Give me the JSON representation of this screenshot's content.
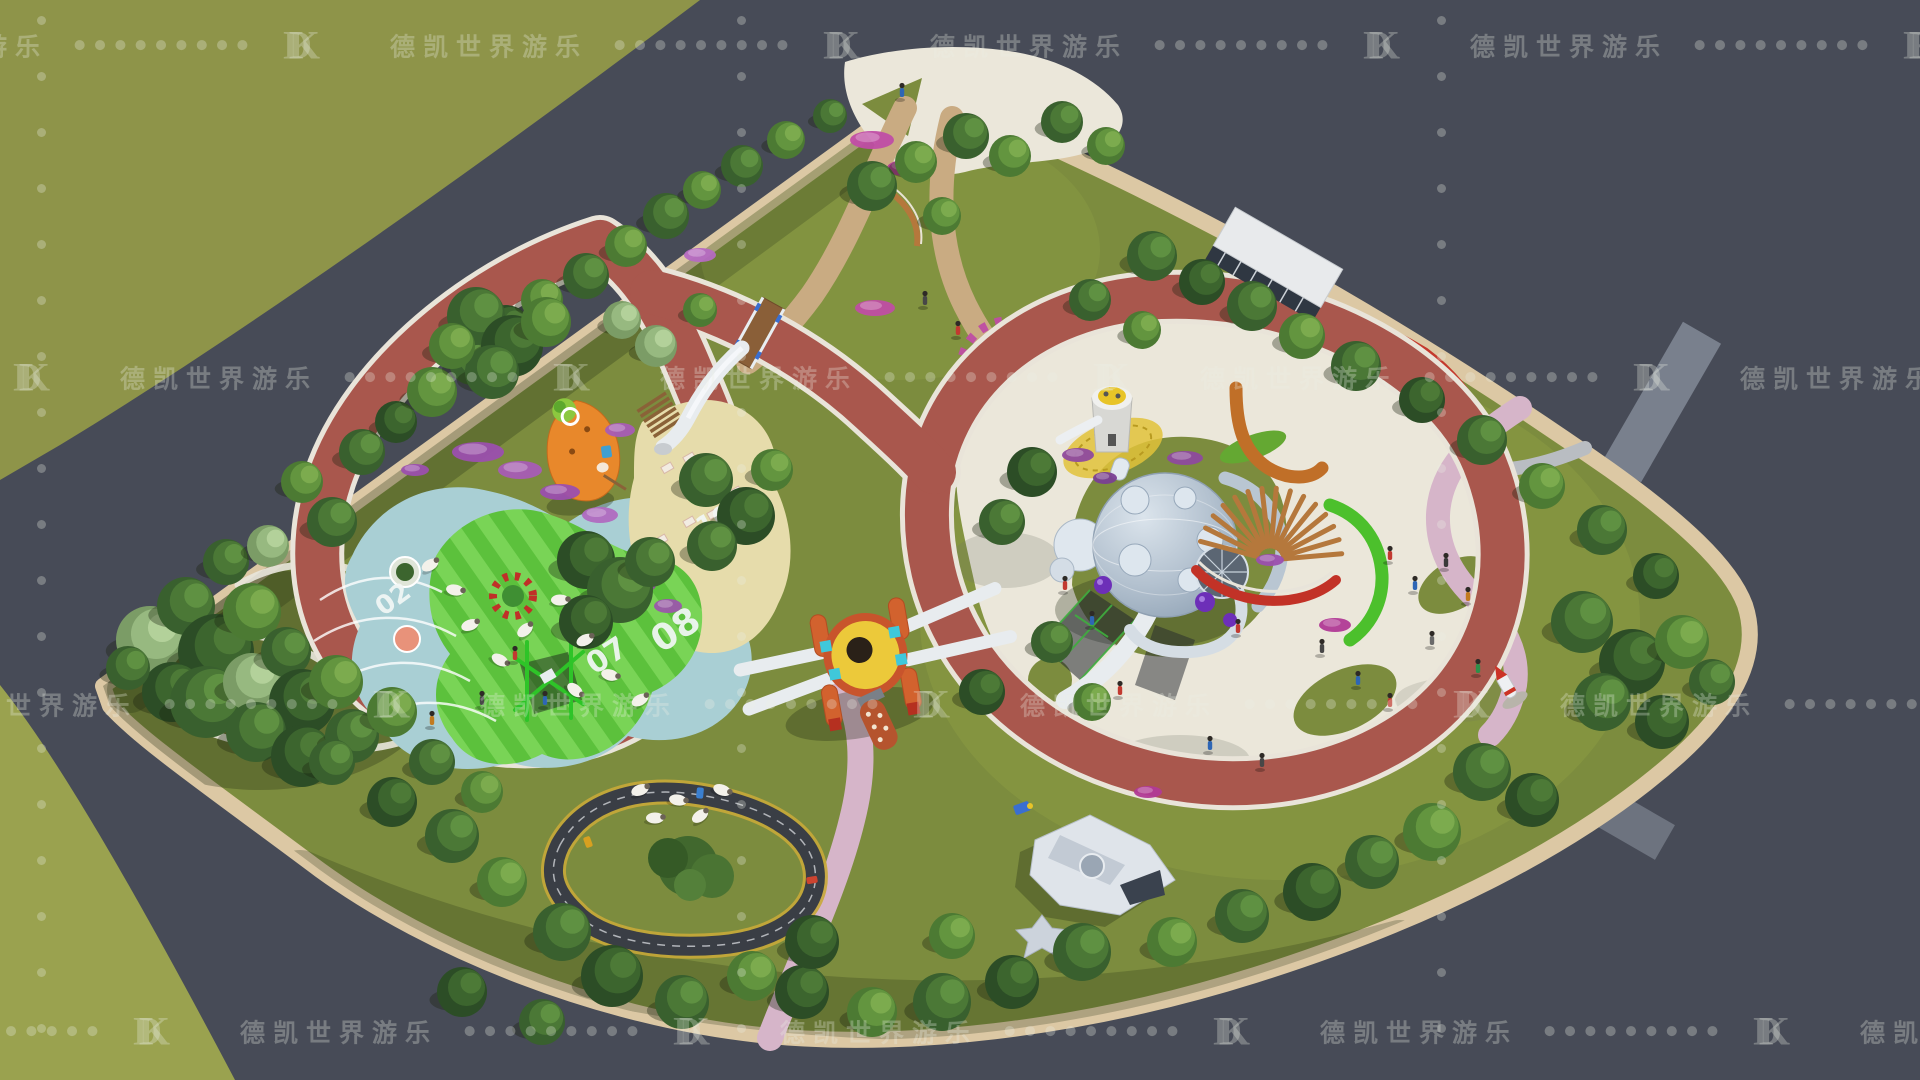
{
  "watermark": {
    "logo": "DK",
    "brand": "德凯世界游乐",
    "dot_char": "●",
    "dots_per_group": 9,
    "rows": [
      {
        "y": 45,
        "dx": -150
      },
      {
        "y": 377,
        "dx": -420
      },
      {
        "y": 704,
        "dx": -60
      },
      {
        "y": 1031,
        "dx": -300
      }
    ],
    "tiles_per_row": 6,
    "columns_x": [
      41,
      741,
      1441
    ],
    "column_dots": 20,
    "color": "rgba(236,240,228,0.30)"
  },
  "labels": {
    "n02": "02",
    "n07": "07",
    "n08": "08",
    "n10": "10"
  },
  "palette": {
    "road": "#474b57",
    "grassTL": "#8e9449",
    "grassBL": "#9aa24f",
    "lawn": "#7c8c3e",
    "sidewalk": "#dcc8a4",
    "trackRed": "#a9574d",
    "trackEdge": "#e9e4d9",
    "pathPink": "#d6b5c9",
    "pathTan": "#c9ab82",
    "plaza": "#ebe7da",
    "teal": "#a9cfd4",
    "stripeA": "#5cc13c",
    "stripeB": "#79d456",
    "sand": "#e6dcab",
    "hedge": "#4cc02c",
    "wood": "#b5783c",
    "accentRed": "#c23227",
    "sphereBody": "#b9c6d2",
    "slideWhite": "#e8ecef",
    "rocketYellow": "#ecc93a",
    "rocketOrange": "#d2622e",
    "connectorCyan": "#3fc8da",
    "kartAsphalt": "#3a3e45",
    "kartYellow": "#c8a838",
    "pondGreen": "#3fa436",
    "carrotOrange": "#e8882b",
    "numberWhite": "#f2f7f6",
    "watermark": "rgba(236,240,228,0.30)"
  },
  "scene": {
    "tree_palette": [
      [
        "#2c4d26",
        "#3c652e",
        "#4d7a37"
      ],
      [
        "#39602e",
        "#4b7836",
        "#5f9142"
      ],
      [
        "#4c7a33",
        "#63953f",
        "#7cab4e"
      ],
      [
        "#7b9c66",
        "#97b980",
        "#b3d19a"
      ]
    ],
    "trees": [
      [
        150,
        640,
        34,
        3
      ],
      [
        186,
        606,
        29,
        1
      ],
      [
        216,
        652,
        38,
        0
      ],
      [
        252,
        612,
        29,
        2
      ],
      [
        172,
        692,
        30,
        0
      ],
      [
        206,
        702,
        36,
        1
      ],
      [
        252,
        682,
        29,
        3
      ],
      [
        286,
        652,
        25,
        1
      ],
      [
        302,
        702,
        33,
        0
      ],
      [
        336,
        682,
        27,
        2
      ],
      [
        256,
        732,
        30,
        1
      ],
      [
        302,
        756,
        31,
        0
      ],
      [
        352,
        736,
        27,
        1
      ],
      [
        392,
        712,
        25,
        2
      ],
      [
        226,
        562,
        23,
        1
      ],
      [
        268,
        546,
        21,
        3
      ],
      [
        128,
        668,
        22,
        1
      ],
      [
        332,
        522,
        25,
        1
      ],
      [
        302,
        482,
        21,
        2
      ],
      [
        362,
        452,
        23,
        1
      ],
      [
        396,
        422,
        21,
        0
      ],
      [
        432,
        392,
        25,
        2
      ],
      [
        472,
        362,
        23,
        1
      ],
      [
        506,
        330,
        25,
        0
      ],
      [
        542,
        300,
        21,
        2
      ],
      [
        586,
        276,
        23,
        1
      ],
      [
        626,
        246,
        21,
        2
      ],
      [
        666,
        216,
        23,
        1
      ],
      [
        702,
        190,
        19,
        2
      ],
      [
        742,
        166,
        21,
        1
      ],
      [
        786,
        140,
        19,
        2
      ],
      [
        830,
        116,
        17,
        1
      ],
      [
        476,
        316,
        29,
        1
      ],
      [
        512,
        346,
        31,
        0
      ],
      [
        546,
        322,
        25,
        2
      ],
      [
        492,
        372,
        27,
        1
      ],
      [
        452,
        346,
        23,
        2
      ],
      [
        586,
        560,
        29,
        0
      ],
      [
        620,
        590,
        33,
        1
      ],
      [
        586,
        622,
        27,
        0
      ],
      [
        650,
        562,
        25,
        1
      ],
      [
        706,
        480,
        27,
        1
      ],
      [
        746,
        516,
        29,
        0
      ],
      [
        712,
        546,
        25,
        1
      ],
      [
        772,
        470,
        21,
        2
      ],
      [
        872,
        186,
        25,
        1
      ],
      [
        916,
        162,
        21,
        2
      ],
      [
        966,
        136,
        23,
        1
      ],
      [
        1010,
        156,
        21,
        2
      ],
      [
        942,
        216,
        19,
        2
      ],
      [
        1062,
        122,
        21,
        1
      ],
      [
        1106,
        146,
        19,
        2
      ],
      [
        1090,
        300,
        21,
        1
      ],
      [
        1142,
        330,
        19,
        2
      ],
      [
        656,
        346,
        21,
        3
      ],
      [
        622,
        320,
        19,
        3
      ],
      [
        700,
        310,
        17,
        2
      ],
      [
        1152,
        256,
        25,
        1
      ],
      [
        1202,
        282,
        23,
        0
      ],
      [
        1252,
        306,
        25,
        1
      ],
      [
        1302,
        336,
        23,
        2
      ],
      [
        1356,
        366,
        25,
        1
      ],
      [
        1422,
        400,
        23,
        0
      ],
      [
        1482,
        440,
        25,
        1
      ],
      [
        1542,
        486,
        23,
        2
      ],
      [
        1602,
        530,
        25,
        1
      ],
      [
        1656,
        576,
        23,
        0
      ],
      [
        1582,
        622,
        31,
        1
      ],
      [
        1632,
        662,
        33,
        0
      ],
      [
        1682,
        642,
        27,
        2
      ],
      [
        1602,
        702,
        29,
        1
      ],
      [
        1662,
        722,
        27,
        0
      ],
      [
        1712,
        682,
        23,
        1
      ],
      [
        1482,
        772,
        29,
        1
      ],
      [
        1532,
        800,
        27,
        0
      ],
      [
        1432,
        832,
        29,
        2
      ],
      [
        1372,
        862,
        27,
        1
      ],
      [
        1312,
        892,
        29,
        0
      ],
      [
        1242,
        916,
        27,
        1
      ],
      [
        1172,
        942,
        25,
        2
      ],
      [
        1082,
        952,
        29,
        1
      ],
      [
        1012,
        982,
        27,
        0
      ],
      [
        942,
        1002,
        29,
        1
      ],
      [
        872,
        1012,
        25,
        2
      ],
      [
        802,
        992,
        27,
        0
      ],
      [
        952,
        936,
        23,
        2
      ],
      [
        562,
        932,
        29,
        1
      ],
      [
        612,
        976,
        31,
        0
      ],
      [
        682,
        1002,
        27,
        1
      ],
      [
        752,
        976,
        25,
        2
      ],
      [
        812,
        942,
        27,
        0
      ],
      [
        502,
        882,
        25,
        2
      ],
      [
        452,
        836,
        27,
        1
      ],
      [
        392,
        802,
        25,
        0
      ],
      [
        332,
        762,
        23,
        1
      ],
      [
        542,
        1022,
        23,
        1
      ],
      [
        462,
        992,
        25,
        0
      ],
      [
        432,
        762,
        23,
        1
      ],
      [
        482,
        792,
        21,
        2
      ],
      [
        1032,
        472,
        25,
        0
      ],
      [
        1002,
        522,
        23,
        1
      ],
      [
        1052,
        642,
        21,
        1
      ],
      [
        982,
        692,
        23,
        0
      ],
      [
        1092,
        702,
        19,
        2
      ]
    ],
    "bushes": [
      [
        478,
        452,
        26,
        10,
        "#9b4fae"
      ],
      [
        520,
        470,
        22,
        9,
        "#a85cb5"
      ],
      [
        560,
        492,
        20,
        8,
        "#9b4fae"
      ],
      [
        600,
        515,
        18,
        8,
        "#b06ac0"
      ],
      [
        640,
        585,
        16,
        8,
        "#8e4a9e"
      ],
      [
        668,
        606,
        14,
        7,
        "#9b57ab"
      ],
      [
        872,
        140,
        22,
        9,
        "#c04da5"
      ],
      [
        905,
        168,
        18,
        8,
        "#b13a96"
      ],
      [
        875,
        308,
        20,
        8,
        "#bf4da3"
      ],
      [
        1078,
        455,
        16,
        7,
        "#8e4a9e"
      ],
      [
        1105,
        478,
        12,
        6,
        "#7a3f93"
      ],
      [
        1185,
        458,
        18,
        7,
        "#8e4a9e"
      ],
      [
        1270,
        560,
        14,
        6,
        "#9b4fae"
      ],
      [
        1335,
        625,
        16,
        7,
        "#b13a96"
      ],
      [
        415,
        470,
        14,
        6,
        "#9b4fae"
      ],
      [
        620,
        430,
        15,
        7,
        "#a85cb5"
      ],
      [
        1148,
        792,
        14,
        6,
        "#b13a96"
      ],
      [
        700,
        255,
        16,
        7,
        "#b56ac2"
      ]
    ],
    "sheep": [
      [
        430,
        565,
        -30
      ],
      [
        455,
        590,
        10
      ],
      [
        470,
        625,
        -20
      ],
      [
        500,
        660,
        30
      ],
      [
        525,
        630,
        -40
      ],
      [
        560,
        600,
        0
      ],
      [
        585,
        640,
        -25
      ],
      [
        610,
        675,
        15
      ],
      [
        640,
        700,
        -30
      ],
      [
        575,
        690,
        40
      ],
      [
        640,
        790,
        -20
      ],
      [
        678,
        800,
        10
      ],
      [
        700,
        816,
        -35
      ],
      [
        722,
        790,
        20
      ],
      [
        655,
        818,
        0
      ]
    ],
    "people": [
      [
        1390,
        555,
        "#c23a30"
      ],
      [
        1415,
        585,
        "#2e66b5"
      ],
      [
        1446,
        562,
        "#3a3a3a"
      ],
      [
        1468,
        596,
        "#c27b20"
      ],
      [
        1358,
        680,
        "#2e66b5"
      ],
      [
        1390,
        702,
        "#c23a30"
      ],
      [
        1322,
        648,
        "#474747"
      ],
      [
        1432,
        640,
        "#6a6a6a"
      ],
      [
        1478,
        668,
        "#2e8f4a"
      ],
      [
        1238,
        628,
        "#c23a30"
      ],
      [
        1210,
        745,
        "#2e66b5"
      ],
      [
        1262,
        762,
        "#474747"
      ],
      [
        1120,
        690,
        "#c23a30"
      ],
      [
        1065,
        585,
        "#c23a30"
      ],
      [
        1092,
        620,
        "#2e66b5"
      ],
      [
        515,
        655,
        "#c23a30"
      ],
      [
        545,
        700,
        "#2e66b5"
      ],
      [
        482,
        700,
        "#474747"
      ],
      [
        432,
        720,
        "#c27b20"
      ],
      [
        925,
        300,
        "#474747"
      ],
      [
        958,
        330,
        "#c23a30"
      ],
      [
        902,
        92,
        "#2e66b5"
      ]
    ],
    "karts": [
      [
        588,
        842,
        -20,
        "#d8a020"
      ],
      [
        700,
        793,
        5,
        "#3a7fd0"
      ],
      [
        812,
        880,
        80,
        "#cc4430"
      ]
    ],
    "pergola": {
      "cx": 1270,
      "cy": 560,
      "r0": 14,
      "r1": 72,
      "a0": -165,
      "a1": -5,
      "n": 15
    }
  }
}
